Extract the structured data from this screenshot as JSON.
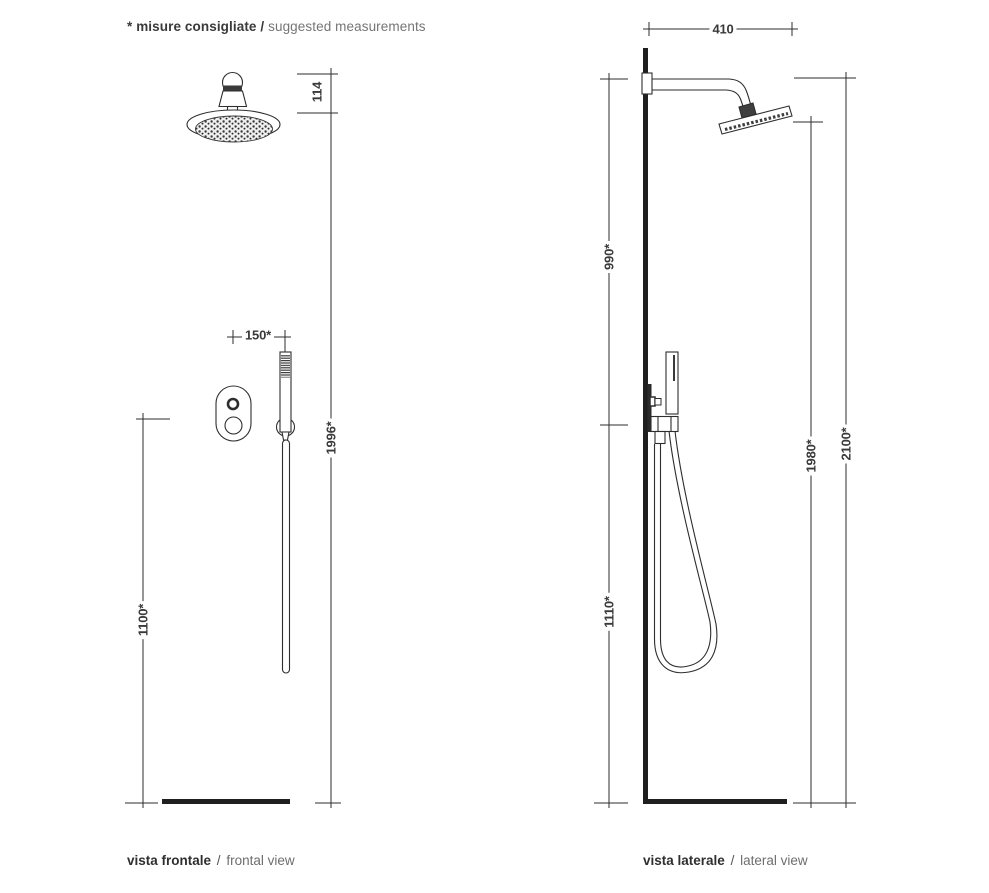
{
  "header": {
    "note_bold": "* misure consigliate /",
    "note_light": "suggested measurements"
  },
  "frontal_view": {
    "caption_bold": "vista frontale",
    "caption_sep": "/",
    "caption_light": "frontal view",
    "dimensions": {
      "head_height": "114",
      "valve_to_handshower": "150*",
      "handshower_height": "1996*",
      "valve_height": "1100*"
    }
  },
  "lateral_view": {
    "caption_bold": "vista laterale",
    "caption_sep": "/",
    "caption_light": "lateral view",
    "dimensions": {
      "arm_projection": "410",
      "arm_to_holder": "990*",
      "holder_to_floor": "1110*",
      "head_height_from_floor": "1980*",
      "arm_height_from_floor": "2100*"
    }
  },
  "colors": {
    "line": "#2e2e2e",
    "solid": "#1f1f1f",
    "text_dark": "#3a3a3a",
    "text_light": "#757575"
  }
}
